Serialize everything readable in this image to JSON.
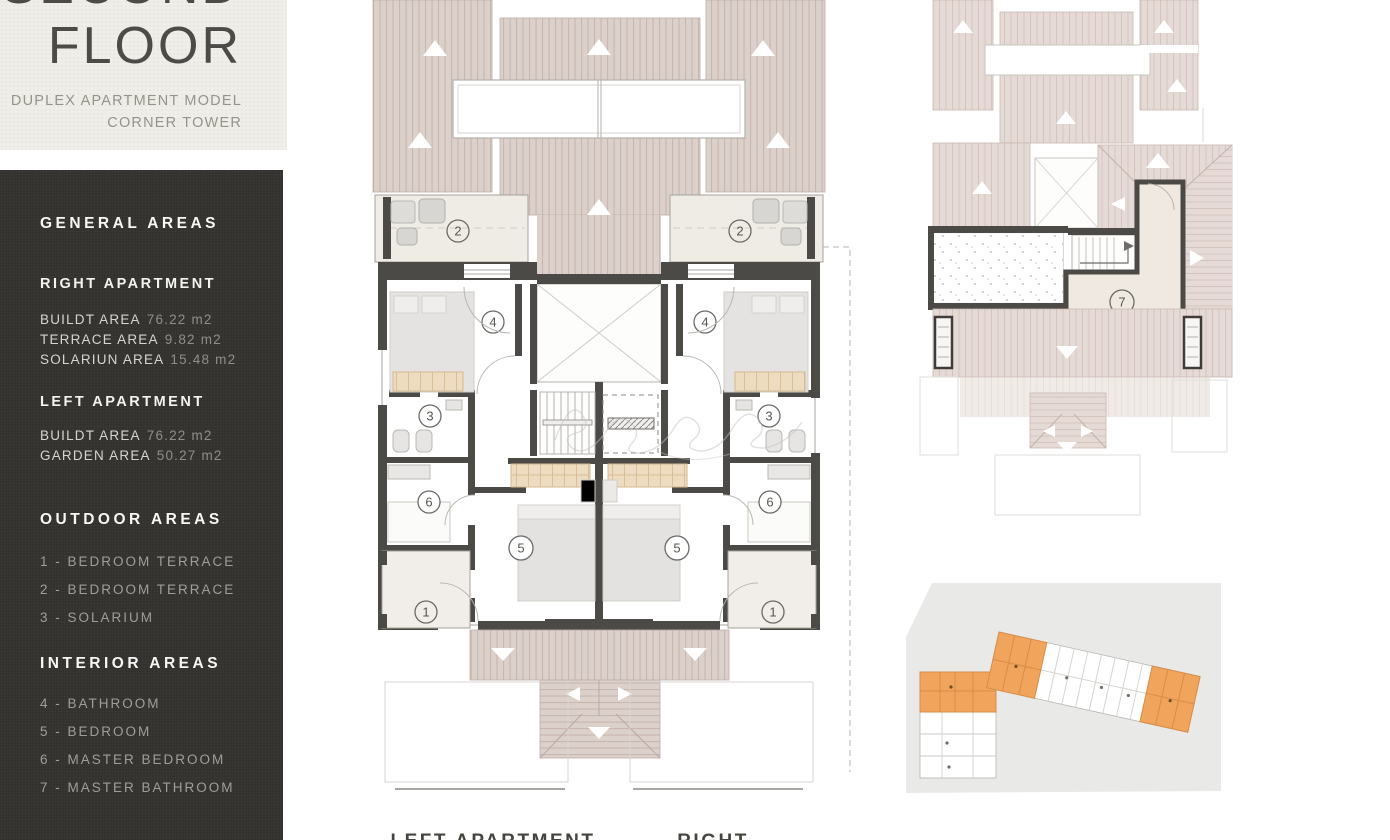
{
  "header": {
    "title_line1": "SECOND",
    "title_line2": "FLOOR",
    "subtitle_line1": "DUPLEX APARTMENT MODEL",
    "subtitle_line2": "CORNER TOWER"
  },
  "sidebar": {
    "general_heading": "GENERAL AREAS",
    "right_apartment": {
      "heading": "RIGHT APARTMENT",
      "rows": [
        {
          "label": "BUILDT AREA",
          "value": "76.22 m2"
        },
        {
          "label": "TERRACE AREA",
          "value": "9.82 m2"
        },
        {
          "label": "SOLARIUN AREA",
          "value": "15.48 m2"
        }
      ]
    },
    "left_apartment": {
      "heading": "LEFT APARTMENT",
      "rows": [
        {
          "label": "BUILDT AREA",
          "value": "76.22 m2"
        },
        {
          "label": "GARDEN AREA",
          "value": "50.27 m2"
        }
      ]
    },
    "outdoor": {
      "heading": "OUTDOOR AREAS",
      "items": [
        "1 - BEDROOM TERRACE",
        "2 - BEDROOM TERRACE",
        "3 - SOLARIUM"
      ]
    },
    "interior": {
      "heading": "INTERIOR AREAS",
      "items": [
        "4 - BATHROOM",
        "5 - BEDROOM",
        "6 - MASTER BEDROOM",
        "7 - MASTER BATHROOM"
      ]
    }
  },
  "plan_labels": {
    "terrace_1": "1",
    "terrace_2": "2",
    "solarium_3": "3",
    "room_4": "4",
    "room_5": "5",
    "room_6": "6",
    "room_7": "7"
  },
  "captions": {
    "left": "LEFT APARTMENT",
    "right": "RIGHT APARTMENT"
  },
  "colors": {
    "sidebar_bg": "#33322f",
    "plate_bg": "#f0eee9",
    "roof_fill": "#dcd0ca",
    "roof_stripe": "#c8b6b0",
    "wall": "#4b4a46",
    "terrace_floor": "#efebe5",
    "closet_tan": "#eedcc0",
    "highlight_orange": "#f0a45c",
    "siteplan_bg": "#e9e9e7"
  }
}
